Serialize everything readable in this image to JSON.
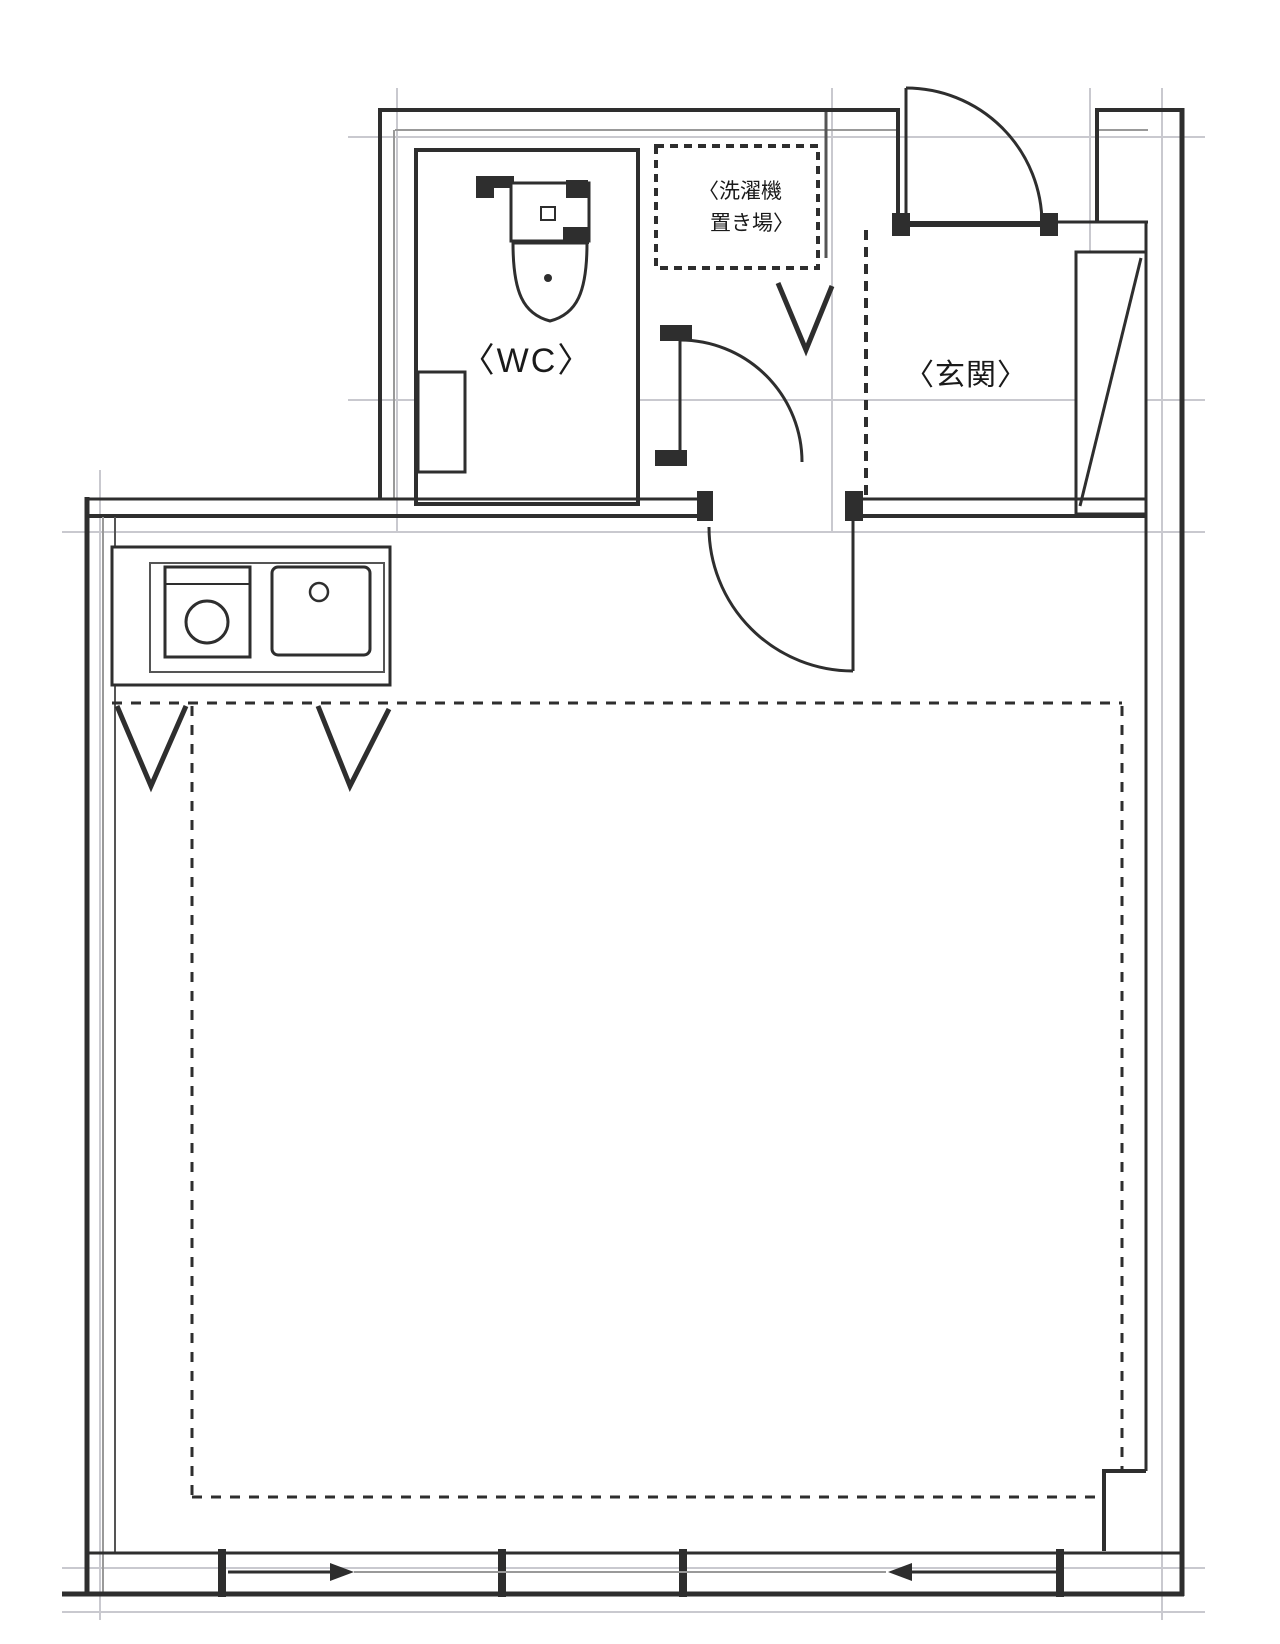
{
  "labels": {
    "wc": "〈WC〉",
    "genkan": "〈玄関〉",
    "washer_line1": "〈洗濯機",
    "washer_line2": "置き場〉"
  },
  "colors": {
    "wall": "#2e2e2e",
    "inner": "#999999",
    "grid": "#c9c9cf",
    "text": "#1a1a1a",
    "bg": "#ffffff",
    "mid": "#555555"
  },
  "fixtures": {
    "toilet": "toilet-icon",
    "stove": "stove-burner-icon",
    "sink": "kitchen-sink-icon",
    "washing_machine_space": "washing-machine-area",
    "shoe_cabinet": "shoe-cabinet",
    "entrance_door": "entrance-door-swing",
    "wc_door": "wc-door-swing",
    "room_door": "room-door-swing",
    "sliding_window": "sliding-window"
  }
}
